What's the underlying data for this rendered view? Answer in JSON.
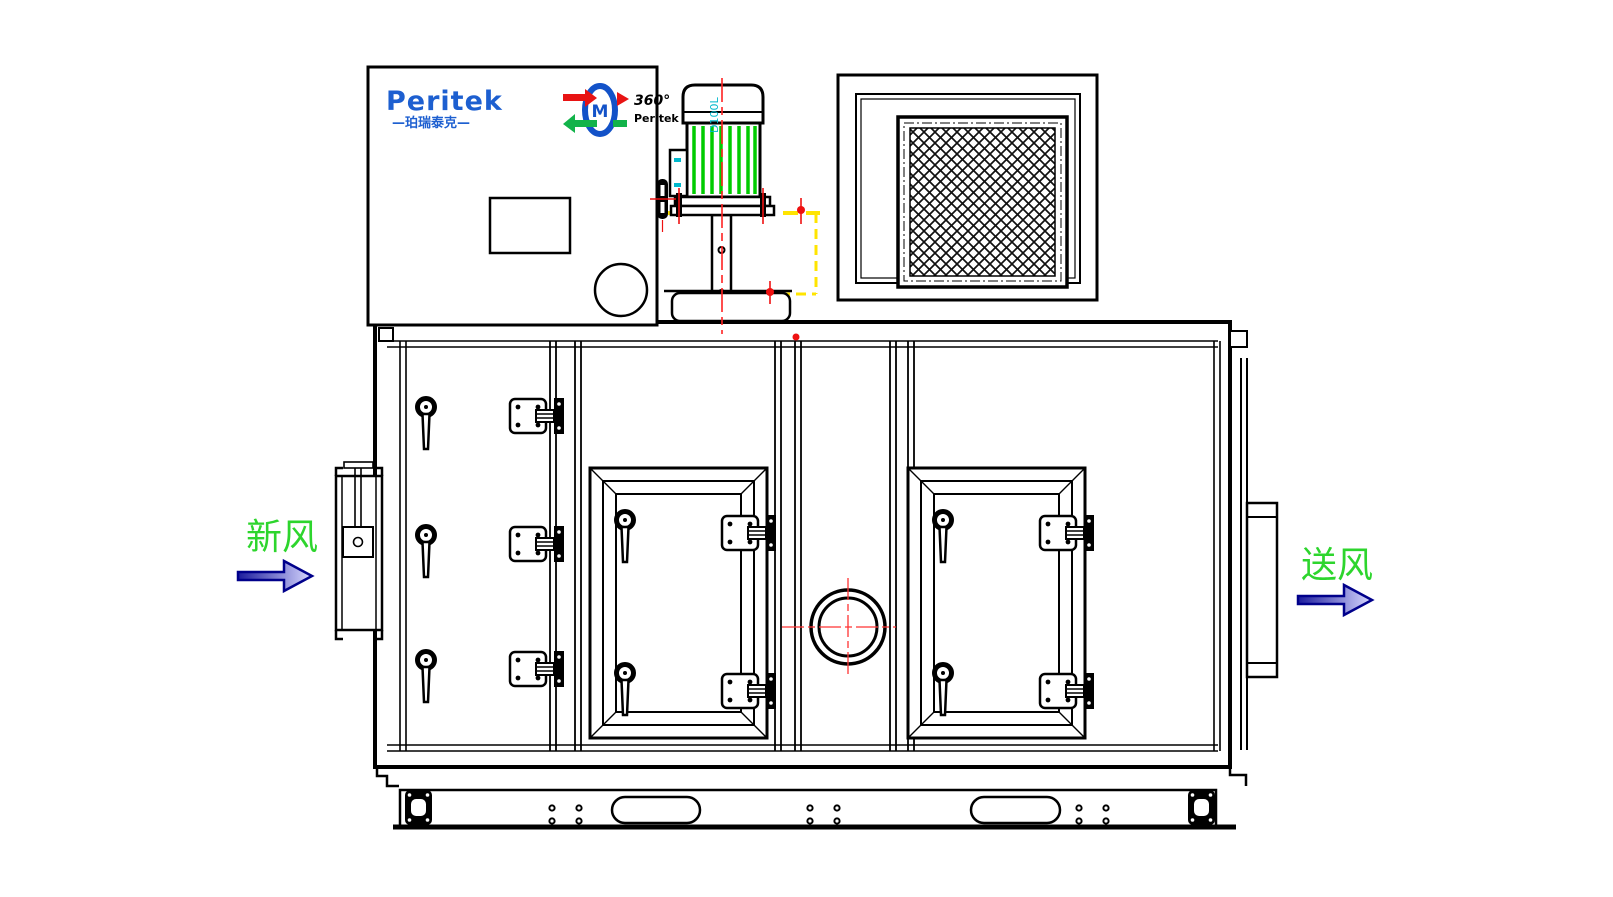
{
  "drawing": {
    "brand": {
      "logo_text": "Peritek",
      "logo_subtext": "—珀瑞泰克—",
      "rotor_logo": {
        "angle_text": "360°",
        "brand_text": "Peritek",
        "hub_text": "M"
      }
    },
    "motor": {
      "model_label": "D100L"
    },
    "labels": {
      "inlet": "新风",
      "outlet": "送风"
    },
    "icons": {
      "inlet_arrow": "→",
      "outlet_arrow": "→"
    },
    "colors": {
      "line_black": "#000000",
      "logo_blue": "#1d5fd0",
      "label_green": "#2dd52d",
      "fin_green": "#00cc00",
      "centerline_red": "#ff2222",
      "bolt_red": "#ee1111",
      "hidden_yellow": "#ffe400",
      "accent_cyan": "#00b8cc",
      "arrow_navy": "#00008b",
      "arrow_fill_dark": "#1c1c9e",
      "arrow_fill_light": "#d9d9ff"
    }
  }
}
